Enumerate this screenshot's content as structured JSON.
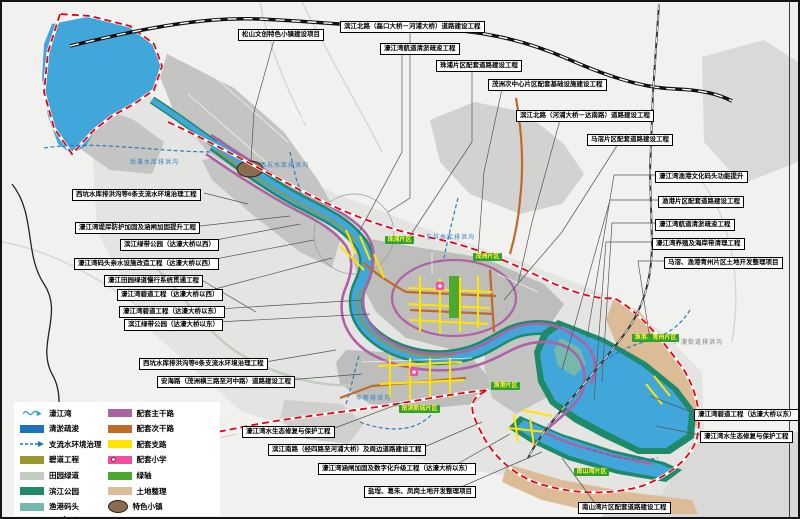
{
  "callouts": [
    {
      "text": "松山文创特色小镇建设项目"
    },
    {
      "text": "滨江北路（磊口大桥－河浦大桥）道路建设工程"
    },
    {
      "text": "濠江湾航道清淤疏浚工程"
    },
    {
      "text": "珠浦片区配套道路建设工程"
    },
    {
      "text": "茂洲次中心片区配套基础设施建设工程"
    },
    {
      "text": "滨江北路（河浦大桥－达南路）道路建设工程"
    },
    {
      "text": "马滘片区配套道路建设工程"
    },
    {
      "text": "濠江湾渔港文化码头功能提升"
    },
    {
      "text": "渔港片区配套道路建设工程"
    },
    {
      "text": "濠江湾航道清淤疏浚工程"
    },
    {
      "text": "濠江湾养殖及海岸带清理工程"
    },
    {
      "text": "马滘、渔港青州片区土地开发整理项目"
    },
    {
      "text": "西坑水库排洪沟等6条支流水环境治理工程"
    },
    {
      "text": "濠江湾堤岸防护加固及涵闸加固提升工程"
    },
    {
      "text": "滨江绿带公园（达濠大桥以西）"
    },
    {
      "text": "濠江湾码头亲水设施改造工程（达濠大桥以西）"
    },
    {
      "text": "濠江田园绿道慢行系统贯通工程"
    },
    {
      "text": "濠江湾碧道工程（达濠大桥以西）"
    },
    {
      "text": "濠江湾碧道工程（达濠大桥以东）"
    },
    {
      "text": "滨江绿带公园（达濠大桥以东）"
    },
    {
      "text": "西坑水库排洪沟等6条支流水环境治理工程"
    },
    {
      "text": "安海路（茂洲横三路至河中路）道路建设工程"
    },
    {
      "text": "濠江湾水生态修复与保护工程"
    },
    {
      "text": "滨江南路（经四路至河浦大桥）及周边道路建设工程"
    },
    {
      "text": "濠江湾涵闸加固及数字化升级工程（达濠大桥以东）"
    },
    {
      "text": "盐埕、葛朱、凤岗土地开发整理项目"
    },
    {
      "text": "南山湾片区配套道路建设工程"
    },
    {
      "text": "濠江湾碧道工程（达濠大桥以东）"
    },
    {
      "text": "濠江湾水生态修复与保护工程"
    }
  ],
  "badges": [
    {
      "text": "珠浦片区"
    },
    {
      "text": "茂洲片区"
    },
    {
      "text": "渔港片区"
    },
    {
      "text": "南滨新城片区"
    },
    {
      "text": "南山湾片区"
    },
    {
      "text": "渔港、青州片区"
    }
  ],
  "streams": [
    {
      "text": "后溪水库排洪沟"
    },
    {
      "text": "西坑水库排洪沟"
    },
    {
      "text": "东坑水库排洪沟"
    },
    {
      "text": "华新排洪沟"
    },
    {
      "text": "广澳街道排洪沟"
    }
  ],
  "legend": {
    "left": [
      {
        "label": "濠江湾"
      },
      {
        "label": "清淤疏浚"
      },
      {
        "label": "支流水环境治理"
      },
      {
        "label": "碧道工程"
      },
      {
        "label": "田园绿道"
      },
      {
        "label": "滨江公园"
      },
      {
        "label": "渔港码头"
      }
    ],
    "right": [
      {
        "label": "配套主干路"
      },
      {
        "label": "配套次干路"
      },
      {
        "label": "配套支路"
      },
      {
        "label": "配套小学"
      },
      {
        "label": "绿轴"
      },
      {
        "label": "土地整理"
      },
      {
        "label": "特色小镇"
      }
    ]
  },
  "colors": {
    "water": "#41a7da",
    "dredge_blue": "#1d74ba",
    "boundary_red": "#e60012",
    "main_road_purple": "#ad62a6",
    "secondary_road_orange": "#c06a28",
    "branch_road_yellow": "#ffe400",
    "school_pink": "#ef4f9e",
    "green_axis": "#4ea72e",
    "riverside_park": "#1f8a6a",
    "wharf_teal": "#74b8ae",
    "bidao_olive": "#97972d",
    "garden_greenway": "#c2ccc0",
    "land_consolidation_tan": "#dcbb97",
    "town_brown": "#8a6c4e",
    "badge_green": "#2ea12e"
  }
}
